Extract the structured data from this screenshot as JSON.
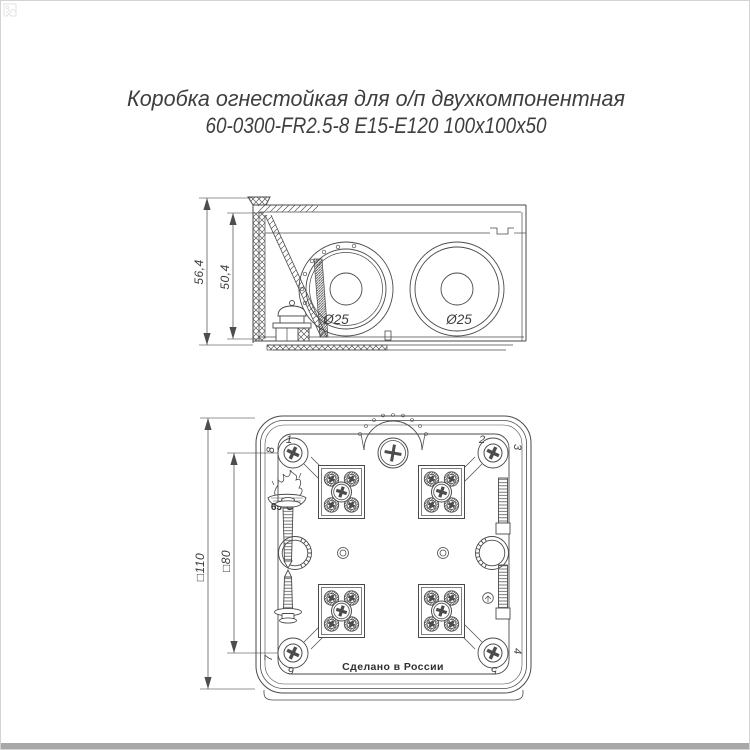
{
  "title": {
    "line1": "Коробка огнестойкая для о/п двухкомпонентная",
    "line2": "60-0300-FR2.5-8 E15-E120 100x100x50"
  },
  "side_view": {
    "dim_outer_height": "56,4",
    "dim_inner_height": "50,4",
    "knockout_left": "Ø25",
    "knockout_right": "Ø25"
  },
  "bottom_view": {
    "dim_outer": "□110",
    "dim_inner": "□80",
    "temperature": "65°С",
    "made_in": "Сделано в России",
    "corners": {
      "c1": "1",
      "c2": "2",
      "c3": "3",
      "c4": "4",
      "c5": "5",
      "c6": "6",
      "c7": "7",
      "c8": "8"
    }
  },
  "colors": {
    "line": "#4a4a4a",
    "dim_line": "#707070",
    "text": "#3e3e3e",
    "page_border": "#d3d3d3",
    "bottom_bar": "#a8a8a8"
  }
}
